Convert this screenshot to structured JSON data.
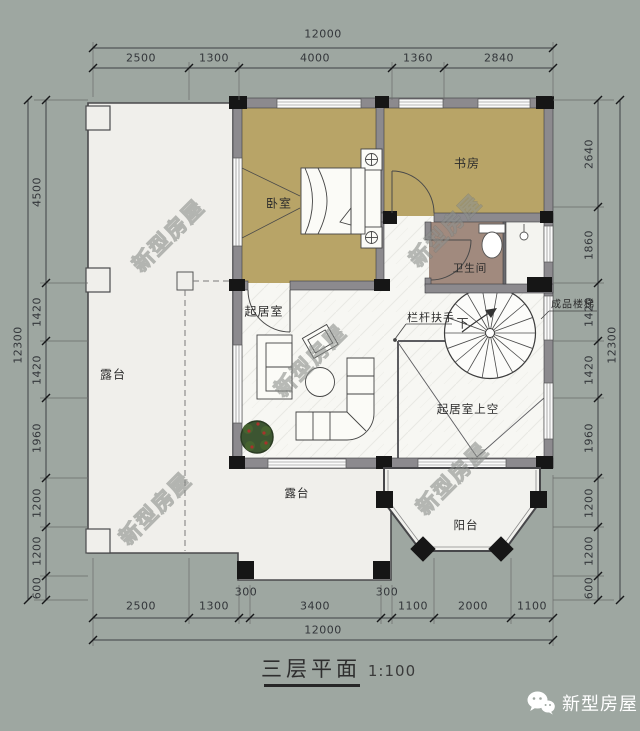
{
  "page": {
    "background": "#9ea7a1",
    "type": "architectural-floor-plan"
  },
  "title": {
    "name": "三层平面",
    "scale": "1:100"
  },
  "branding": {
    "account_name": "新型房屋",
    "icon": "wechat-icon"
  },
  "watermark": {
    "text": "新型房屋"
  },
  "rooms": {
    "bedroom": "卧室",
    "study": "书房",
    "bathroom": "卫生间",
    "living_room": "起居室",
    "living_room_void": "起居室上空",
    "terrace_left": "露台",
    "terrace_lower": "露台",
    "balcony": "阳台"
  },
  "annotations": {
    "railing": "栏杆扶手",
    "stair_down": "下",
    "prefab_stair": "成品楼梯"
  },
  "dimensions": {
    "top": {
      "total": "12000",
      "segments": [
        "2500",
        "1300",
        "4000",
        "1360",
        "2840"
      ]
    },
    "bottom": {
      "total": "12000",
      "segments": [
        "2500",
        "1300",
        "300",
        "3400",
        "300",
        "1100",
        "2000",
        "1100"
      ]
    },
    "left": {
      "total": "12300",
      "segments": [
        "4500",
        "1420",
        "1420",
        "1960",
        "1200",
        "1200",
        "600"
      ]
    },
    "right": {
      "total": "12300",
      "segments": [
        "2640",
        "1860",
        "1420",
        "1420",
        "1960",
        "1200",
        "1200",
        "600"
      ]
    }
  },
  "colors": {
    "background": "#9ea7a1",
    "room_fill_tan": "#b8a467",
    "bathroom_fill": "#a18a7e",
    "wall_gray": "#8c8a8e",
    "wall_black": "#161616",
    "floor_light": "#f0efeb",
    "line_dark": "#3a3a3a"
  }
}
